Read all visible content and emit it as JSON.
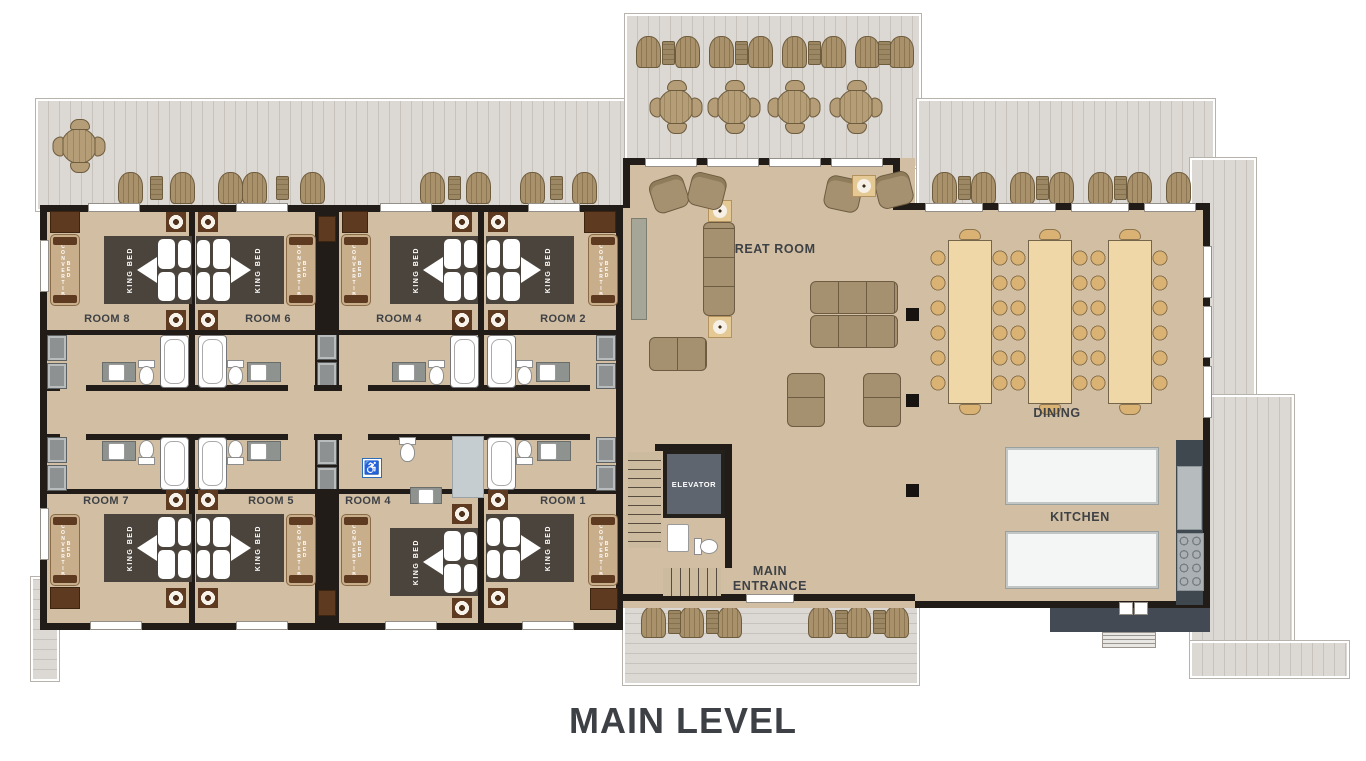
{
  "title": "MAIN LEVEL",
  "areas": {
    "great_room": "GREAT ROOM",
    "dining": "DINING",
    "kitchen": "KITCHEN",
    "elevator": "ELEVATOR",
    "main_entrance_line1": "MAIN",
    "main_entrance_line2": "ENTRANCE"
  },
  "rooms": [
    {
      "name": "ROOM 8",
      "bed": "KING BED",
      "sofa": "CONVERTIBLE BED"
    },
    {
      "name": "ROOM 6",
      "bed": "KING BED",
      "sofa": "CONVERTIBLE BED"
    },
    {
      "name": "ROOM 4",
      "bed": "KING BED",
      "sofa": "CONVERTIBLE BED"
    },
    {
      "name": "ROOM 2",
      "bed": "KING BED",
      "sofa": "CONVERTIBLE BED"
    },
    {
      "name": "ROOM 7",
      "bed": "KING BED",
      "sofa": "CONVERTIBLE BED"
    },
    {
      "name": "ROOM 5",
      "bed": "KING BED",
      "sofa": "CONVERTIBLE BED"
    },
    {
      "name": "ROOM 4",
      "bed": "KING BED",
      "sofa": "CONVERTIBLE BED"
    },
    {
      "name": "ROOM 1",
      "bed": "KING BED",
      "sofa": "CONVERTIBLE BED"
    }
  ],
  "icons": {
    "wheelchair": "♿"
  },
  "colors": {
    "floor": "#d2bfa3",
    "deck": "#dcd8d3",
    "wall": "#211c18",
    "bed": "#4a443c",
    "wood_brown": "#5d3a20",
    "sofa_tan": "#c9ae8b",
    "lounge": "#a59070",
    "dining_table": "#f0d7a8",
    "dining_chair": "#d9b274",
    "kitchen_table": "#f4f6f5",
    "counter": "#3f474f",
    "elevator": "#5e656e",
    "label": "#3e4145",
    "accessible_blue": "#2e6cb5"
  }
}
